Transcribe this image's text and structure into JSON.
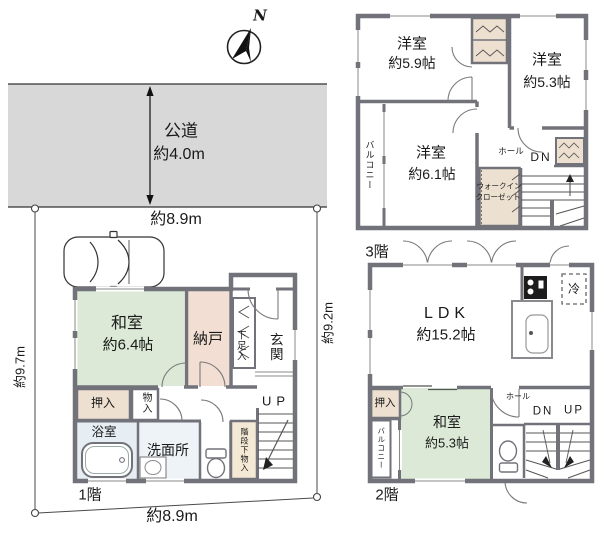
{
  "colors": {
    "road_gray": "#d8d8d8",
    "wall_gray": "#72727a",
    "tatami_green": "#dbe9d6",
    "storage_pink": "#f2ded2",
    "closet_beige": "#eee0d0",
    "understairs_cream": "#f4e9d4",
    "bath_blue": "#e7eef3"
  },
  "site": {
    "compass": "N",
    "road_label": "公道",
    "road_width": "約4.0m",
    "road_frontage": "約8.9m",
    "site_width": "約8.9m",
    "site_depth_left": "約9.7m",
    "site_depth_right": "約9.2m"
  },
  "floor1": {
    "label": "1階",
    "washitsu_name": "和室",
    "washitsu_size": "約6.4帖",
    "nando": "納戸",
    "shoe_cabinet": "下足入",
    "entrance": "玄関",
    "up": "UP",
    "oshiire": "押入",
    "monoire": "物入",
    "bathroom": "浴室",
    "washroom": "洗面所",
    "under_stairs": "階段下物入"
  },
  "floor2": {
    "label": "2階",
    "ldk_name": "LDK",
    "ldk_size": "約15.2帖",
    "fridge": "冷",
    "oshiire": "押入",
    "balcony": "バルコニー",
    "washitsu_name": "和室",
    "washitsu_size": "約5.3帖",
    "hall": "ホール",
    "dn": "DN",
    "up": "UP"
  },
  "floor3": {
    "label": "3階",
    "room1_name": "洋室",
    "room1_size": "約5.9帖",
    "room2_name": "洋室",
    "room2_size": "約5.3帖",
    "room3_name": "洋室",
    "room3_size": "約6.1帖",
    "balcony": "バルコニー",
    "hall": "ホール",
    "dn": "DN",
    "wic_line1": "ウォークイン",
    "wic_line2": "クローゼット"
  }
}
